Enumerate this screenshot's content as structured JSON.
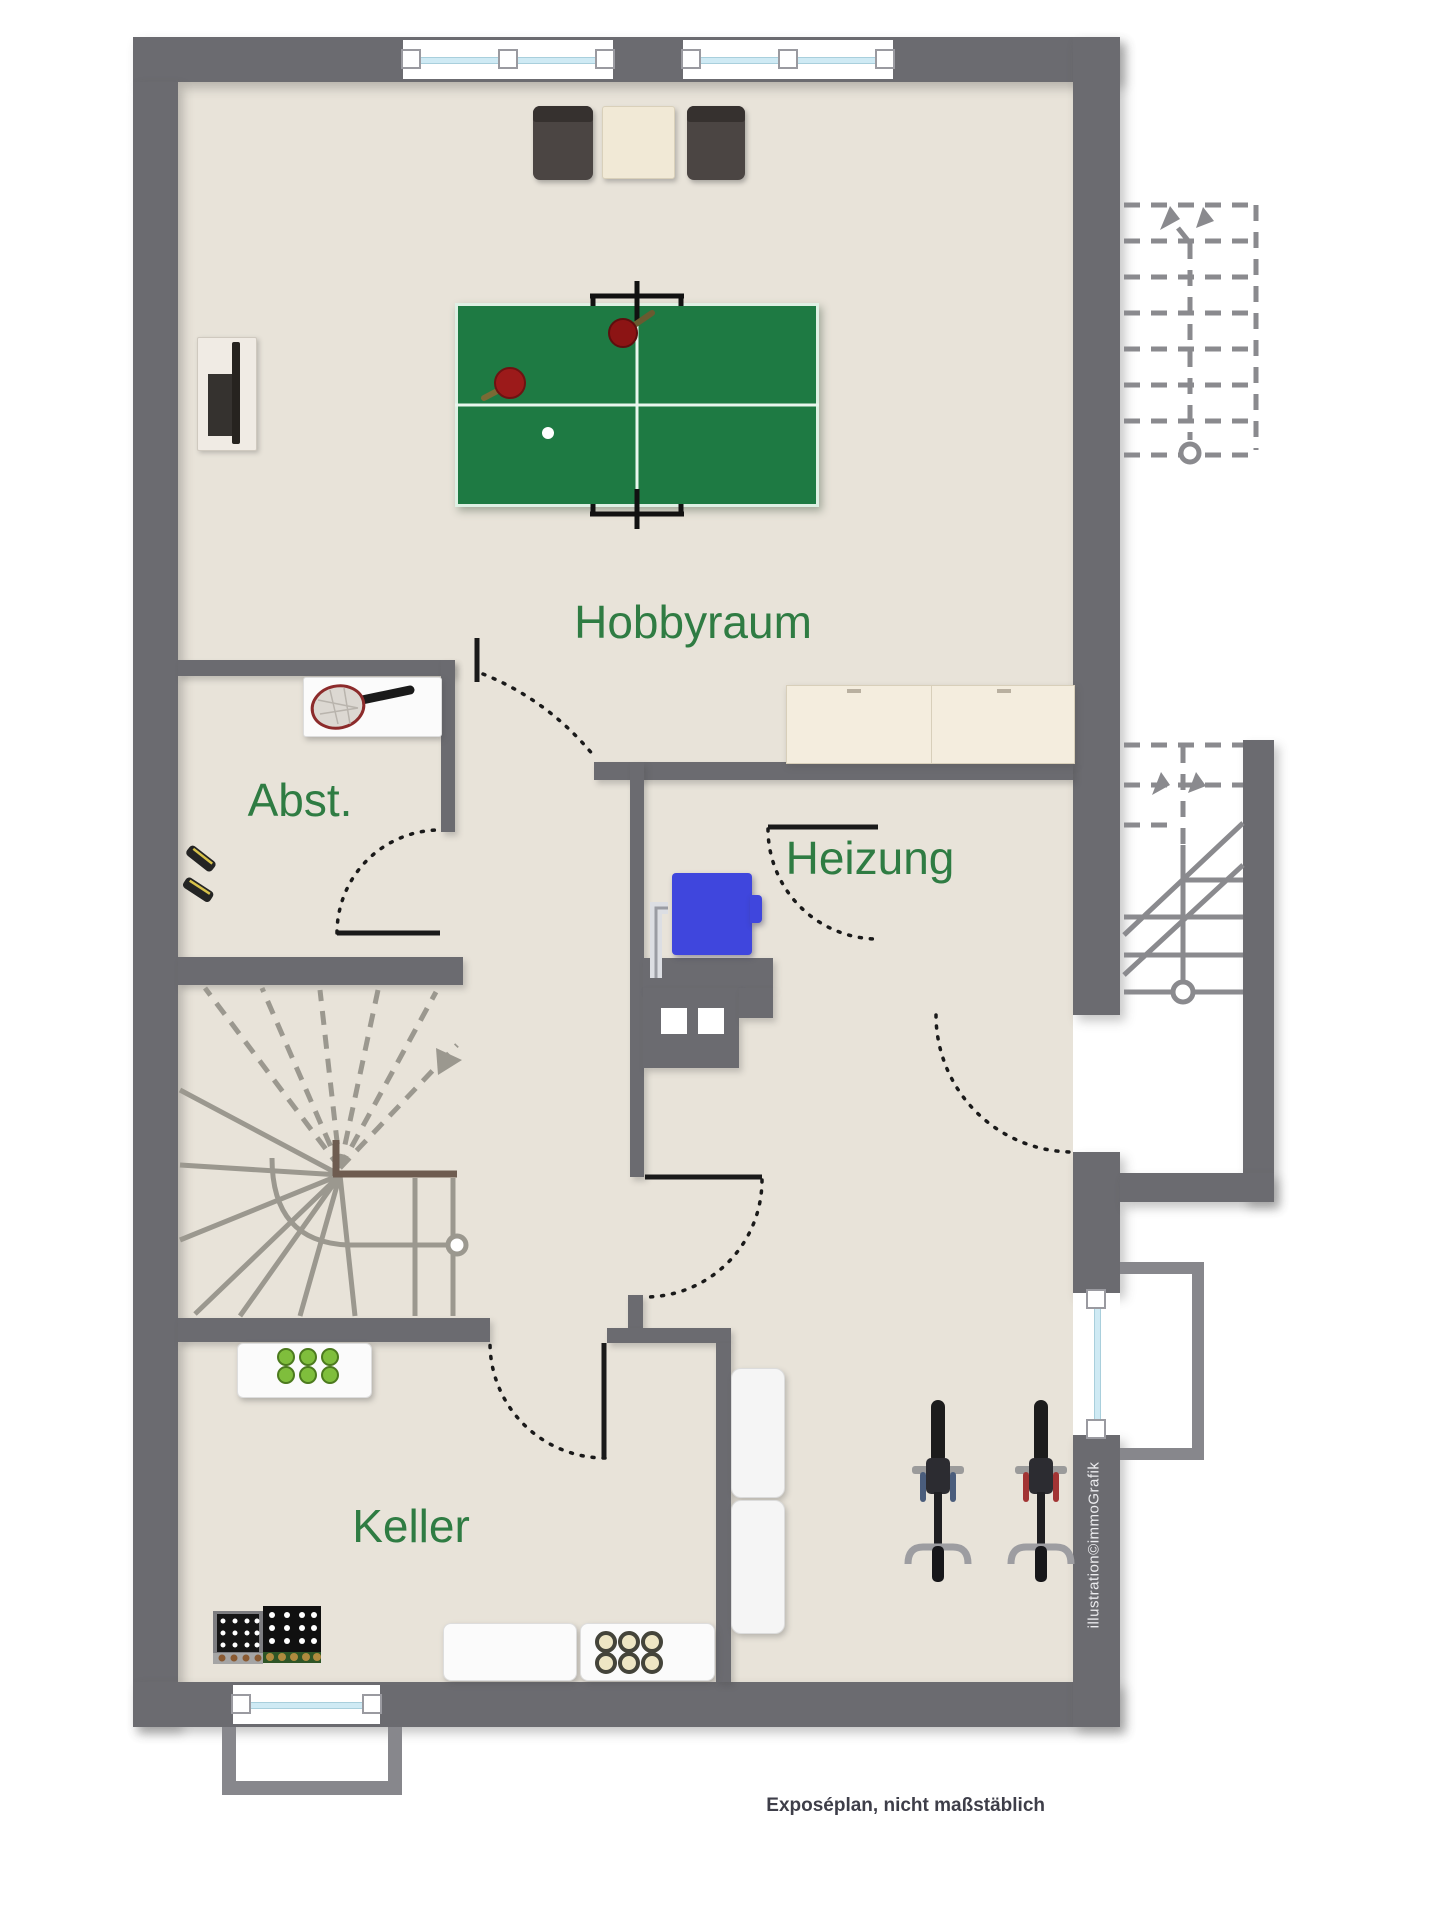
{
  "plan": {
    "rooms": [
      {
        "id": "hobbyraum",
        "label": "Hobbyraum"
      },
      {
        "id": "abstellraum",
        "label": "Abst."
      },
      {
        "id": "heizung",
        "label": "Heizung"
      },
      {
        "id": "keller",
        "label": "Keller"
      }
    ],
    "footer_note": "Exposéplan, nicht maßstäblich",
    "credit": "illustration©immoGrafik"
  },
  "colors": {
    "wall": "#6b6b70",
    "floor": "#e8e3d9",
    "outside": "#ffffff",
    "label_green": "#2f7c43",
    "window_glass": "#cfeaf4",
    "window_frame": "#ffffff",
    "table_green": "#1e7a43",
    "table_line": "#e9f6ee",
    "paddle_red": "#9c1a1a",
    "boiler_blue": "#3f46dd",
    "stair_line": "#9b988f",
    "stair_dash": "#8a8a8e",
    "landing_brown": "#6e5c50",
    "door_line": "#1a1a1a",
    "cabinet_cream": "#f4edde",
    "chair_dark": "#4b4543",
    "bottle_green": "#7fbe3c",
    "bottle_olive": "#eee6c4",
    "bike_accent_blue": "#4a5d7c",
    "bike_accent_red": "#a23434",
    "footer_text": "#3e3e49",
    "credit_text": "#ececef"
  }
}
